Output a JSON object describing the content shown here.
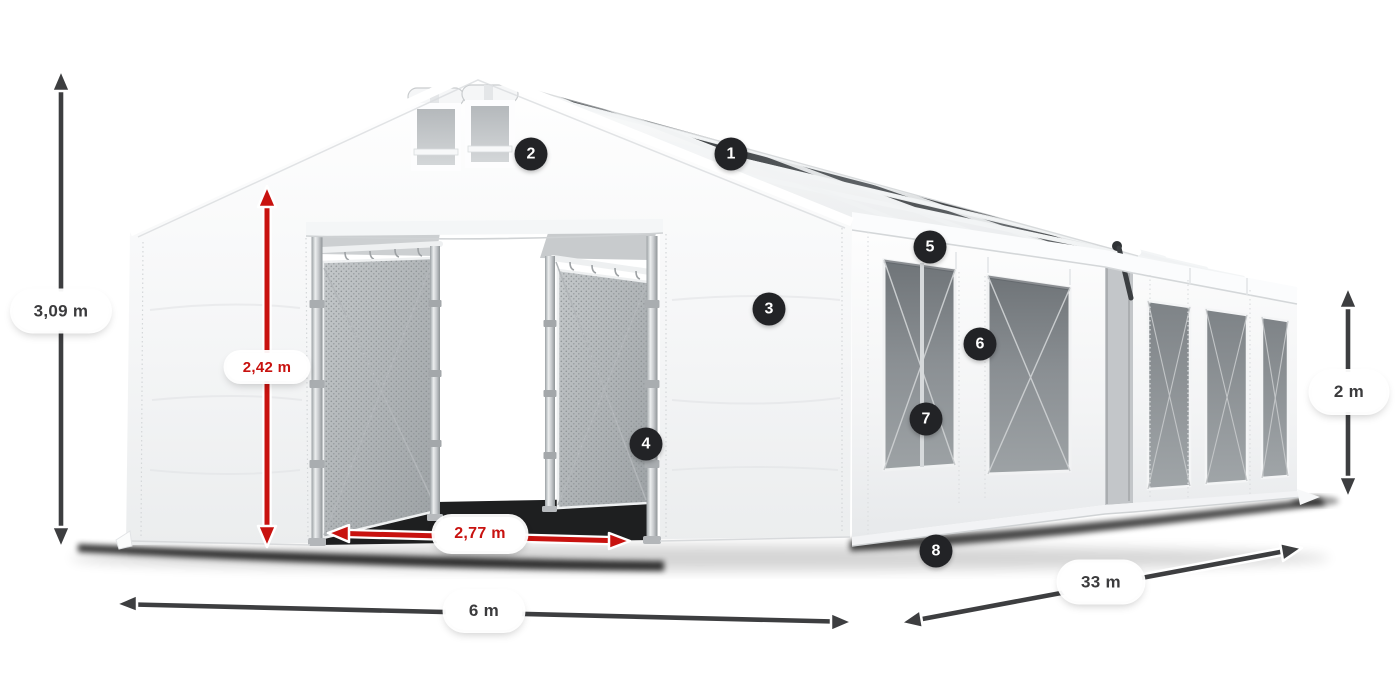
{
  "figure": {
    "description": "White PVC storage tent 6 x 33 m with numbered part callouts and dimension arrows",
    "background": "#ffffff"
  },
  "colors": {
    "accent_red": "#c8120f",
    "arrow_dark": "#3d3e40",
    "badge_bg": "#222326",
    "badge_text": "#ffffff",
    "label_bg": "#ffffff",
    "label_text": "#3b3b3d",
    "tent_white": "#f6f7f8",
    "roof_glazing": "#2f3336",
    "mesh_gray": "#abb0b3",
    "window_gray": "#84898d"
  },
  "dimensions": [
    {
      "id": "total-height",
      "label": "3,09 m",
      "style": "dark"
    },
    {
      "id": "door-height",
      "label": "2,42 m",
      "style": "red"
    },
    {
      "id": "door-width",
      "label": "2,77 m",
      "style": "red"
    },
    {
      "id": "width",
      "label": "6 m",
      "style": "dark"
    },
    {
      "id": "length",
      "label": "33 m",
      "style": "dark"
    },
    {
      "id": "side-height",
      "label": "2 m",
      "style": "dark"
    }
  ],
  "callouts": [
    {
      "number": "1"
    },
    {
      "number": "2"
    },
    {
      "number": "3"
    },
    {
      "number": "4"
    },
    {
      "number": "5"
    },
    {
      "number": "6"
    },
    {
      "number": "7"
    },
    {
      "number": "8"
    }
  ]
}
